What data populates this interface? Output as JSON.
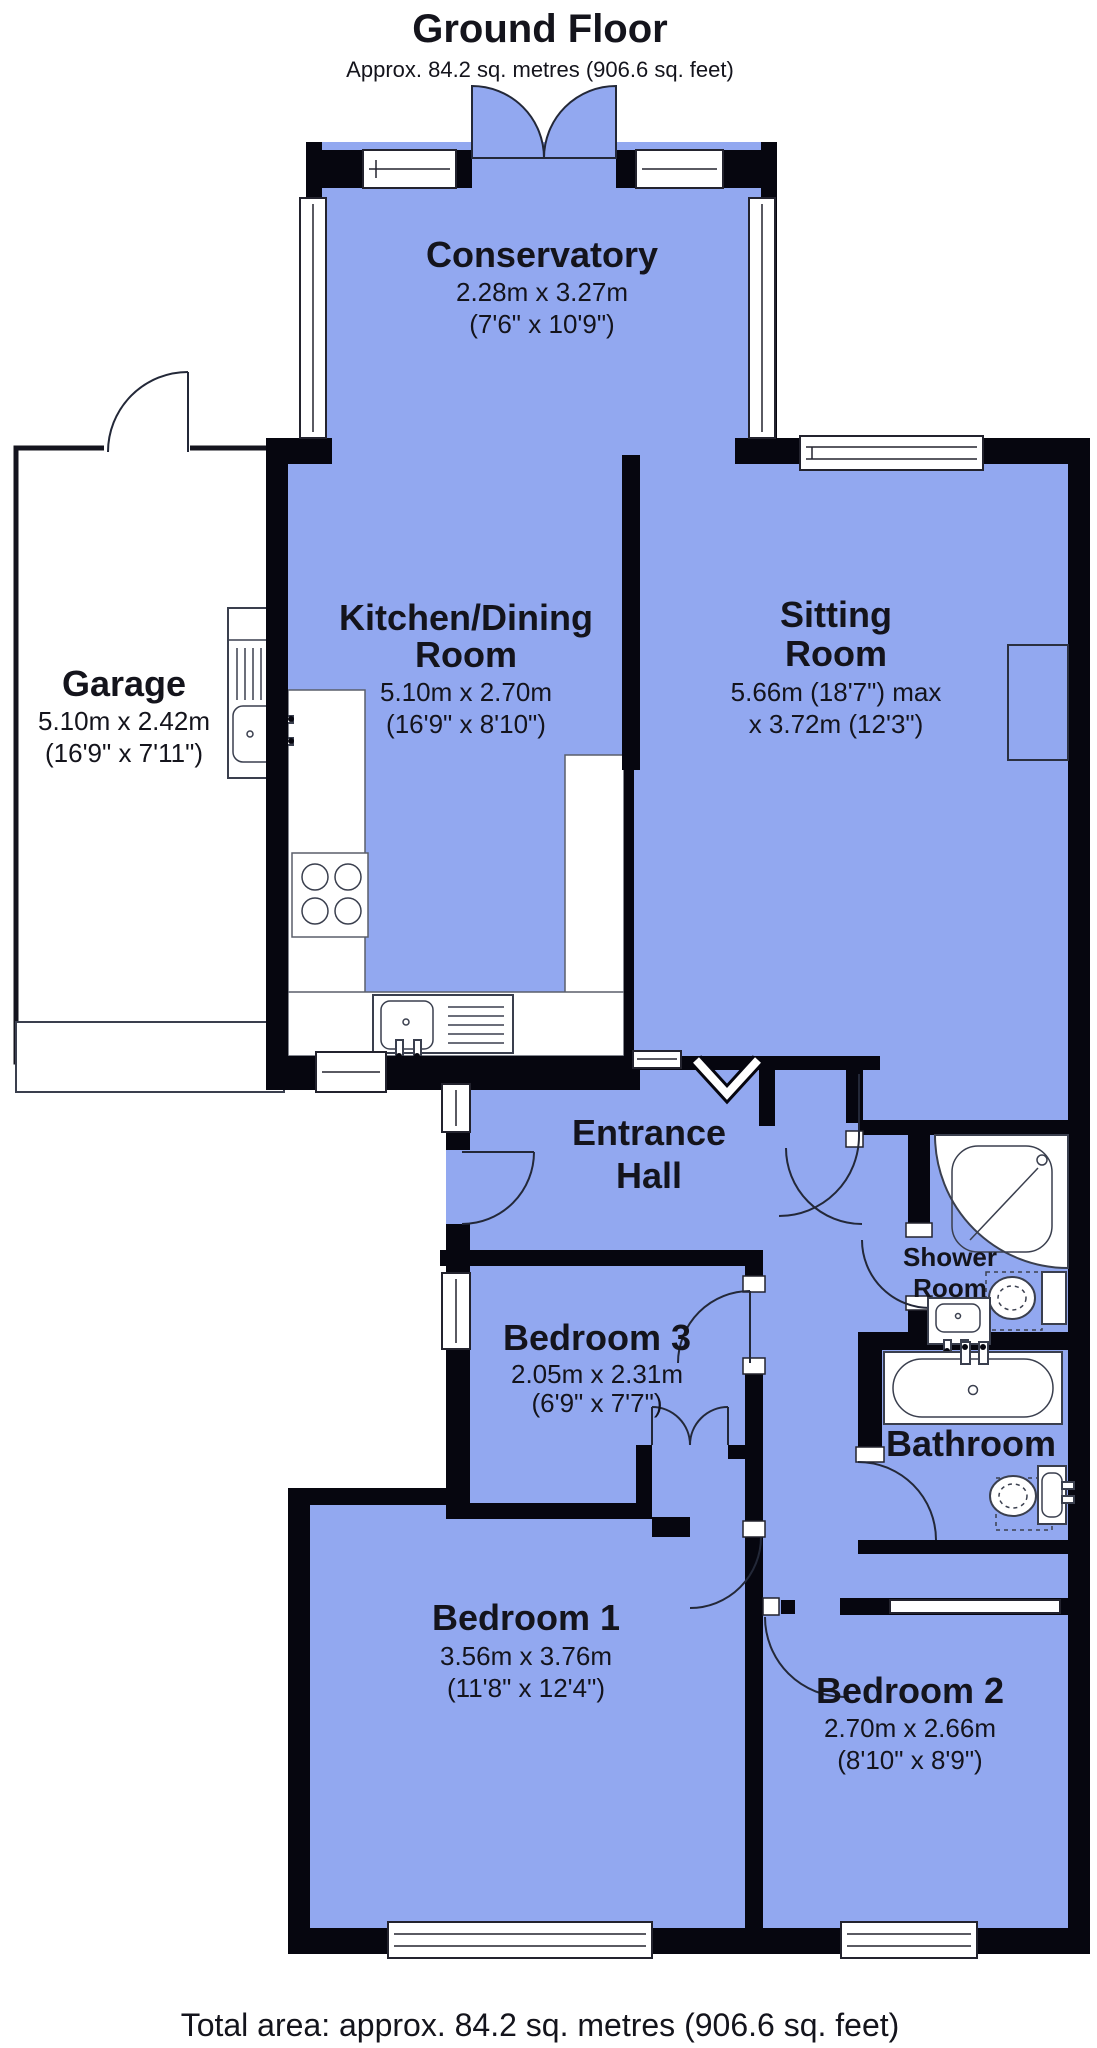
{
  "header": {
    "title": "Ground Floor",
    "subtitle": "Approx. 84.2 sq. metres (906.6 sq. feet)"
  },
  "footer": {
    "total_area": "Total area: approx. 84.2 sq. metres (906.6 sq. feet)"
  },
  "colors": {
    "room_fill": "#92a8f0",
    "wall": "#06060f",
    "text": "#14141c"
  },
  "rooms": {
    "conservatory": {
      "name": "Conservatory",
      "dims_metric": "2.28m x 3.27m",
      "dims_imperial": "(7'6\" x 10'9\")"
    },
    "garage": {
      "name": "Garage",
      "dims_metric": "5.10m x 2.42m",
      "dims_imperial": "(16'9\" x 7'11\")"
    },
    "kitchen": {
      "name_line1": "Kitchen/Dining",
      "name_line2": "Room",
      "dims_metric": "5.10m x 2.70m",
      "dims_imperial": "(16'9\" x 8'10\")"
    },
    "sitting": {
      "name_line1": "Sitting",
      "name_line2": "Room",
      "dims_line1": "5.66m (18'7\") max",
      "dims_line2": "x 3.72m (12'3\")"
    },
    "hall": {
      "name_line1": "Entrance",
      "name_line2": "Hall"
    },
    "bed3": {
      "name": "Bedroom 3",
      "dims_metric": "2.05m x 2.31m",
      "dims_imperial": "(6'9\" x 7'7\")"
    },
    "shower": {
      "name_line1": "Shower",
      "name_line2": "Room"
    },
    "bathroom": {
      "name": "Bathroom"
    },
    "bed1": {
      "name": "Bedroom 1",
      "dims_metric": "3.56m x 3.76m",
      "dims_imperial": "(11'8\" x 12'4\")"
    },
    "bed2": {
      "name": "Bedroom 2",
      "dims_metric": "2.70m x 2.66m",
      "dims_imperial": "(8'10\" x 8'9\")"
    }
  }
}
